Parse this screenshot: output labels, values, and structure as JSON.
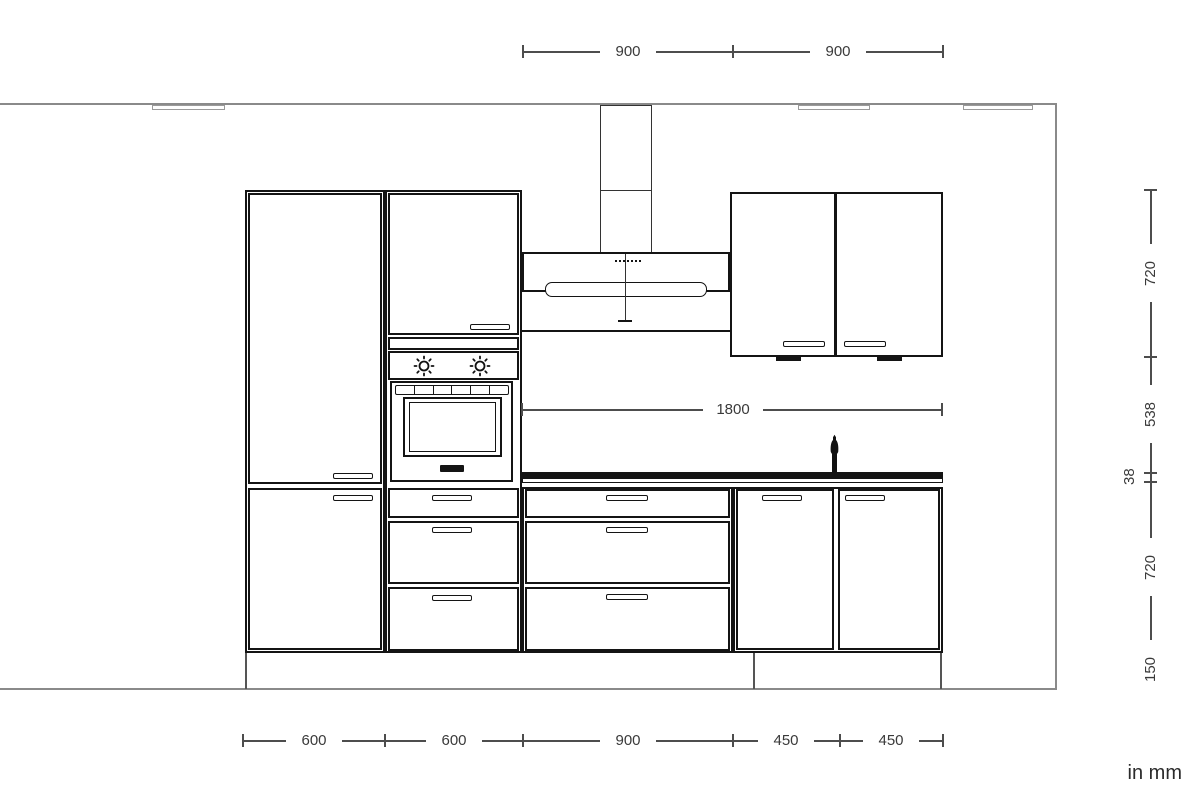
{
  "unit_label": "in mm",
  "colors": {
    "drawing_line": "#141414",
    "wall_line": "#8a8a8a",
    "dimension_line": "#4d4d4d",
    "dimension_text": "#3a3a3a",
    "background": "#ffffff"
  },
  "dims": {
    "top": {
      "seg1": "900",
      "seg2": "900"
    },
    "niche": {
      "value": "1800"
    },
    "bottom": {
      "seg1": "600",
      "seg2": "600",
      "seg3": "900",
      "seg4": "450",
      "seg5": "450"
    },
    "right": {
      "seg1": "720",
      "seg2": "538",
      "seg3": "38",
      "seg4": "720",
      "seg5": "150"
    }
  },
  "icons": {
    "oven_knob_icon": "circle-with-rays",
    "faucet_icon": "tap-silhouette",
    "hood_controls_icon": "dotted-line",
    "handle_icon": "bar-handle",
    "under_cabinet_light_icon": "filled-bar"
  }
}
